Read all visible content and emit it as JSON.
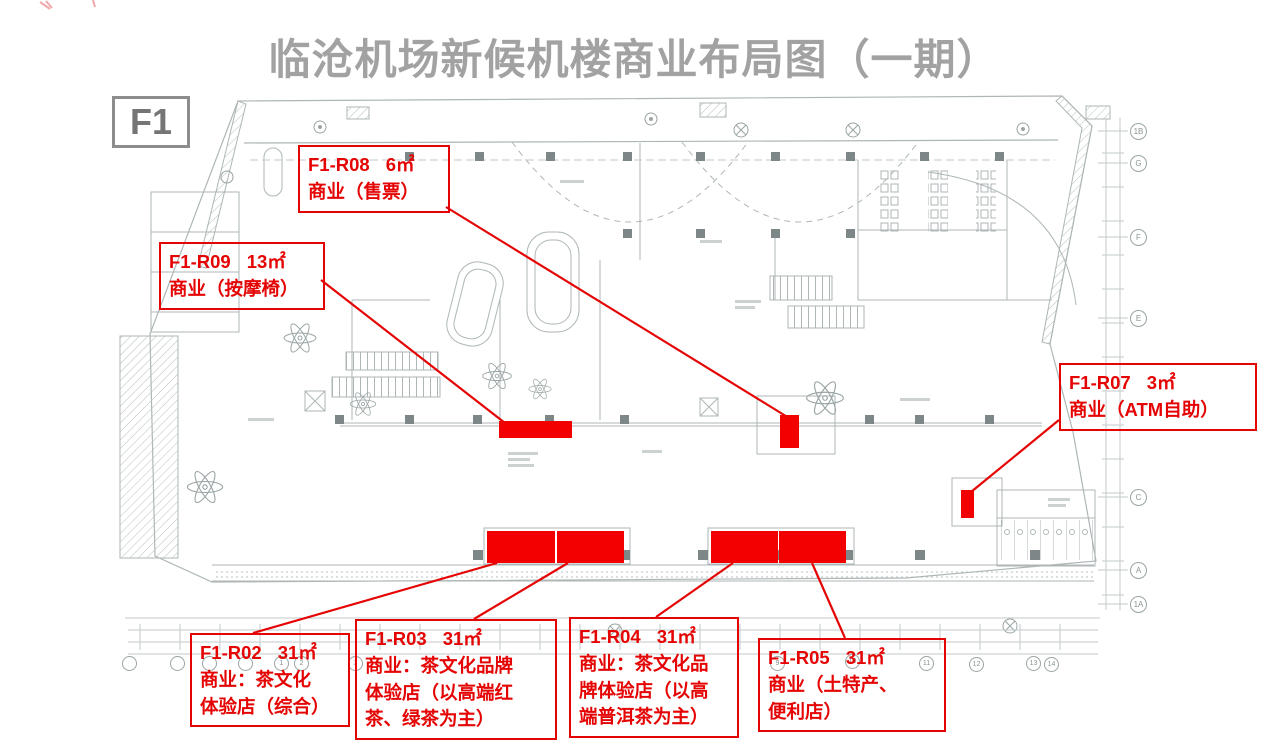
{
  "page": {
    "title": "临沧机场新候机楼商业布局图（一期）",
    "floor_label": "F1"
  },
  "colors": {
    "accent_red": "#e50404",
    "region_fill_red": "#f20000",
    "title_gray": "#a2a2a2",
    "plan_line_gray": "#aeb6b6"
  },
  "callouts": [
    {
      "code": "F1-R08",
      "area": "6㎡",
      "desc_lines": [
        "商业（售票）"
      ]
    },
    {
      "code": "F1-R09",
      "area": "13㎡",
      "desc_lines": [
        "商业（按摩椅）"
      ]
    },
    {
      "code": "F1-R07",
      "area": "3㎡",
      "desc_lines": [
        "商业（ATM自助）"
      ]
    },
    {
      "code": "F1-R02",
      "area": "31㎡",
      "desc_lines": [
        "商业：茶文化",
        "体验店（综合）"
      ]
    },
    {
      "code": "F1-R03",
      "area": "31㎡",
      "desc_lines": [
        "商业：茶文化品牌",
        "体验店（以高端红",
        "茶、绿茶为主）"
      ]
    },
    {
      "code": "F1-R04",
      "area": "31㎡",
      "desc_lines": [
        "商业：茶文化品",
        "牌体验店（以高",
        "端普洱茶为主）"
      ]
    },
    {
      "code": "F1-R05",
      "area": "31㎡",
      "desc_lines": [
        "商业（土特产、",
        "便利店）"
      ]
    }
  ],
  "grid_bubbles": {
    "right": [
      "1B",
      "G",
      "F",
      "E",
      "C",
      "A",
      "1A"
    ],
    "bottom": [
      "",
      "",
      "",
      "",
      "1",
      "2",
      "3",
      "9",
      "10",
      "11",
      "12",
      "13",
      "14"
    ]
  }
}
